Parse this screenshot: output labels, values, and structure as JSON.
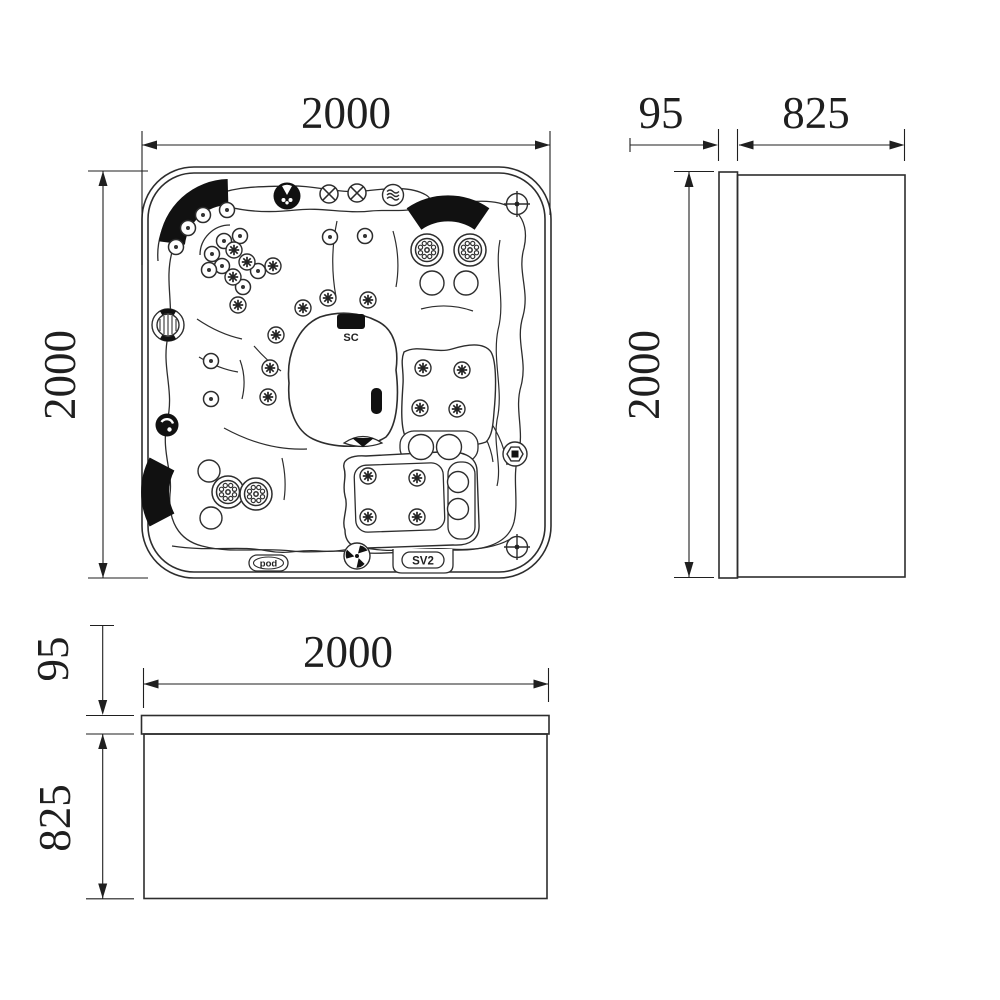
{
  "drawing": {
    "background": "#ffffff",
    "line_color": "#2d2d2d",
    "dimension_color": "#1f1f1f",
    "black_fill": "#111111",
    "top_view": {
      "width_dim": "2000",
      "length_dim": "2000",
      "control_panel_label": "SC",
      "valve_label": "SV2",
      "audio_dock_label": "pod"
    },
    "side_view": {
      "rim_dim": "95",
      "depth_dim": "825",
      "length_dim": "2000"
    },
    "front_view": {
      "width_dim": "2000",
      "rim_dim": "95",
      "height_dim": "825"
    },
    "icons": {
      "air_valve": "circle-x",
      "waterfall_control": "circle-waves",
      "speaker": "black-circle-emblem",
      "corner_screw": "circle-cross",
      "massage_jet": "circle-dot",
      "air_jet": "circle-asterisk",
      "rotary_jet": "ring-of-nozzles",
      "rotary_valve": "tri-blade",
      "suction_fitting": "black-swirl",
      "turbo_jet": "ribbed-circle",
      "drain_fitting": "hex-square"
    }
  }
}
